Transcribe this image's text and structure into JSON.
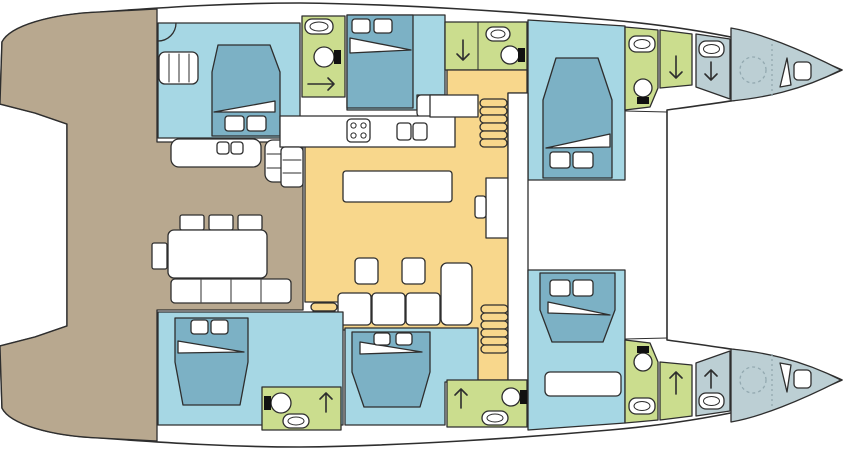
{
  "meta": {
    "title": "Catamaran yacht deck plan — top view",
    "view": "floor-plan"
  },
  "colors": {
    "deck": "#b8a88f",
    "cabin": "#a6d7e4",
    "bed": "#7cb1c5",
    "bath": "#cbdd8e",
    "salon": "#f8d78c",
    "bow": "#bccfd4",
    "outline": "#2e2e2e",
    "tank": "#111111",
    "ghost": "#93a9b0"
  },
  "areas": {
    "cockpit": {
      "label": "aft cockpit deck",
      "features": [
        "dining-table",
        "chairs",
        "bench-seat",
        "wet-bar-counter",
        "companionway-steps"
      ]
    },
    "salon": {
      "label": "salon and galley",
      "features": [
        "galley-counter",
        "stove",
        "double-sink",
        "island-counter",
        "sofa",
        "footstools",
        "nav-desk",
        "fridge"
      ]
    },
    "port_hull": {
      "label": "port hull (top)",
      "cabins": 3,
      "heads": 3
    },
    "starboard_hull": {
      "label": "starboard hull (bottom)",
      "cabins": 3,
      "heads": 3
    },
    "bows": {
      "label": "forepeaks",
      "features": [
        "crew-area",
        "washbasin",
        "deck-hatch",
        "optional-head-dashed"
      ]
    },
    "stairs": {
      "count": 3,
      "label": "companionway stairs to hulls"
    }
  },
  "icons": {
    "toilet": "circle-with-tank",
    "washbasin": "rounded-rect-with-oval",
    "shower": "quarter-arc",
    "stove": "square-with-4-burners",
    "galley_sink": "twin-rounded-rects",
    "bed": "tapered-mattress-with-pillows-and-sheet-fold",
    "arrow_down": "companionway-direction",
    "arrow_up": "companionway-direction",
    "arrow_right": "door-direction",
    "deck_hatch": "square-with-open-lid",
    "dashed_circle": "optional-fitting"
  }
}
